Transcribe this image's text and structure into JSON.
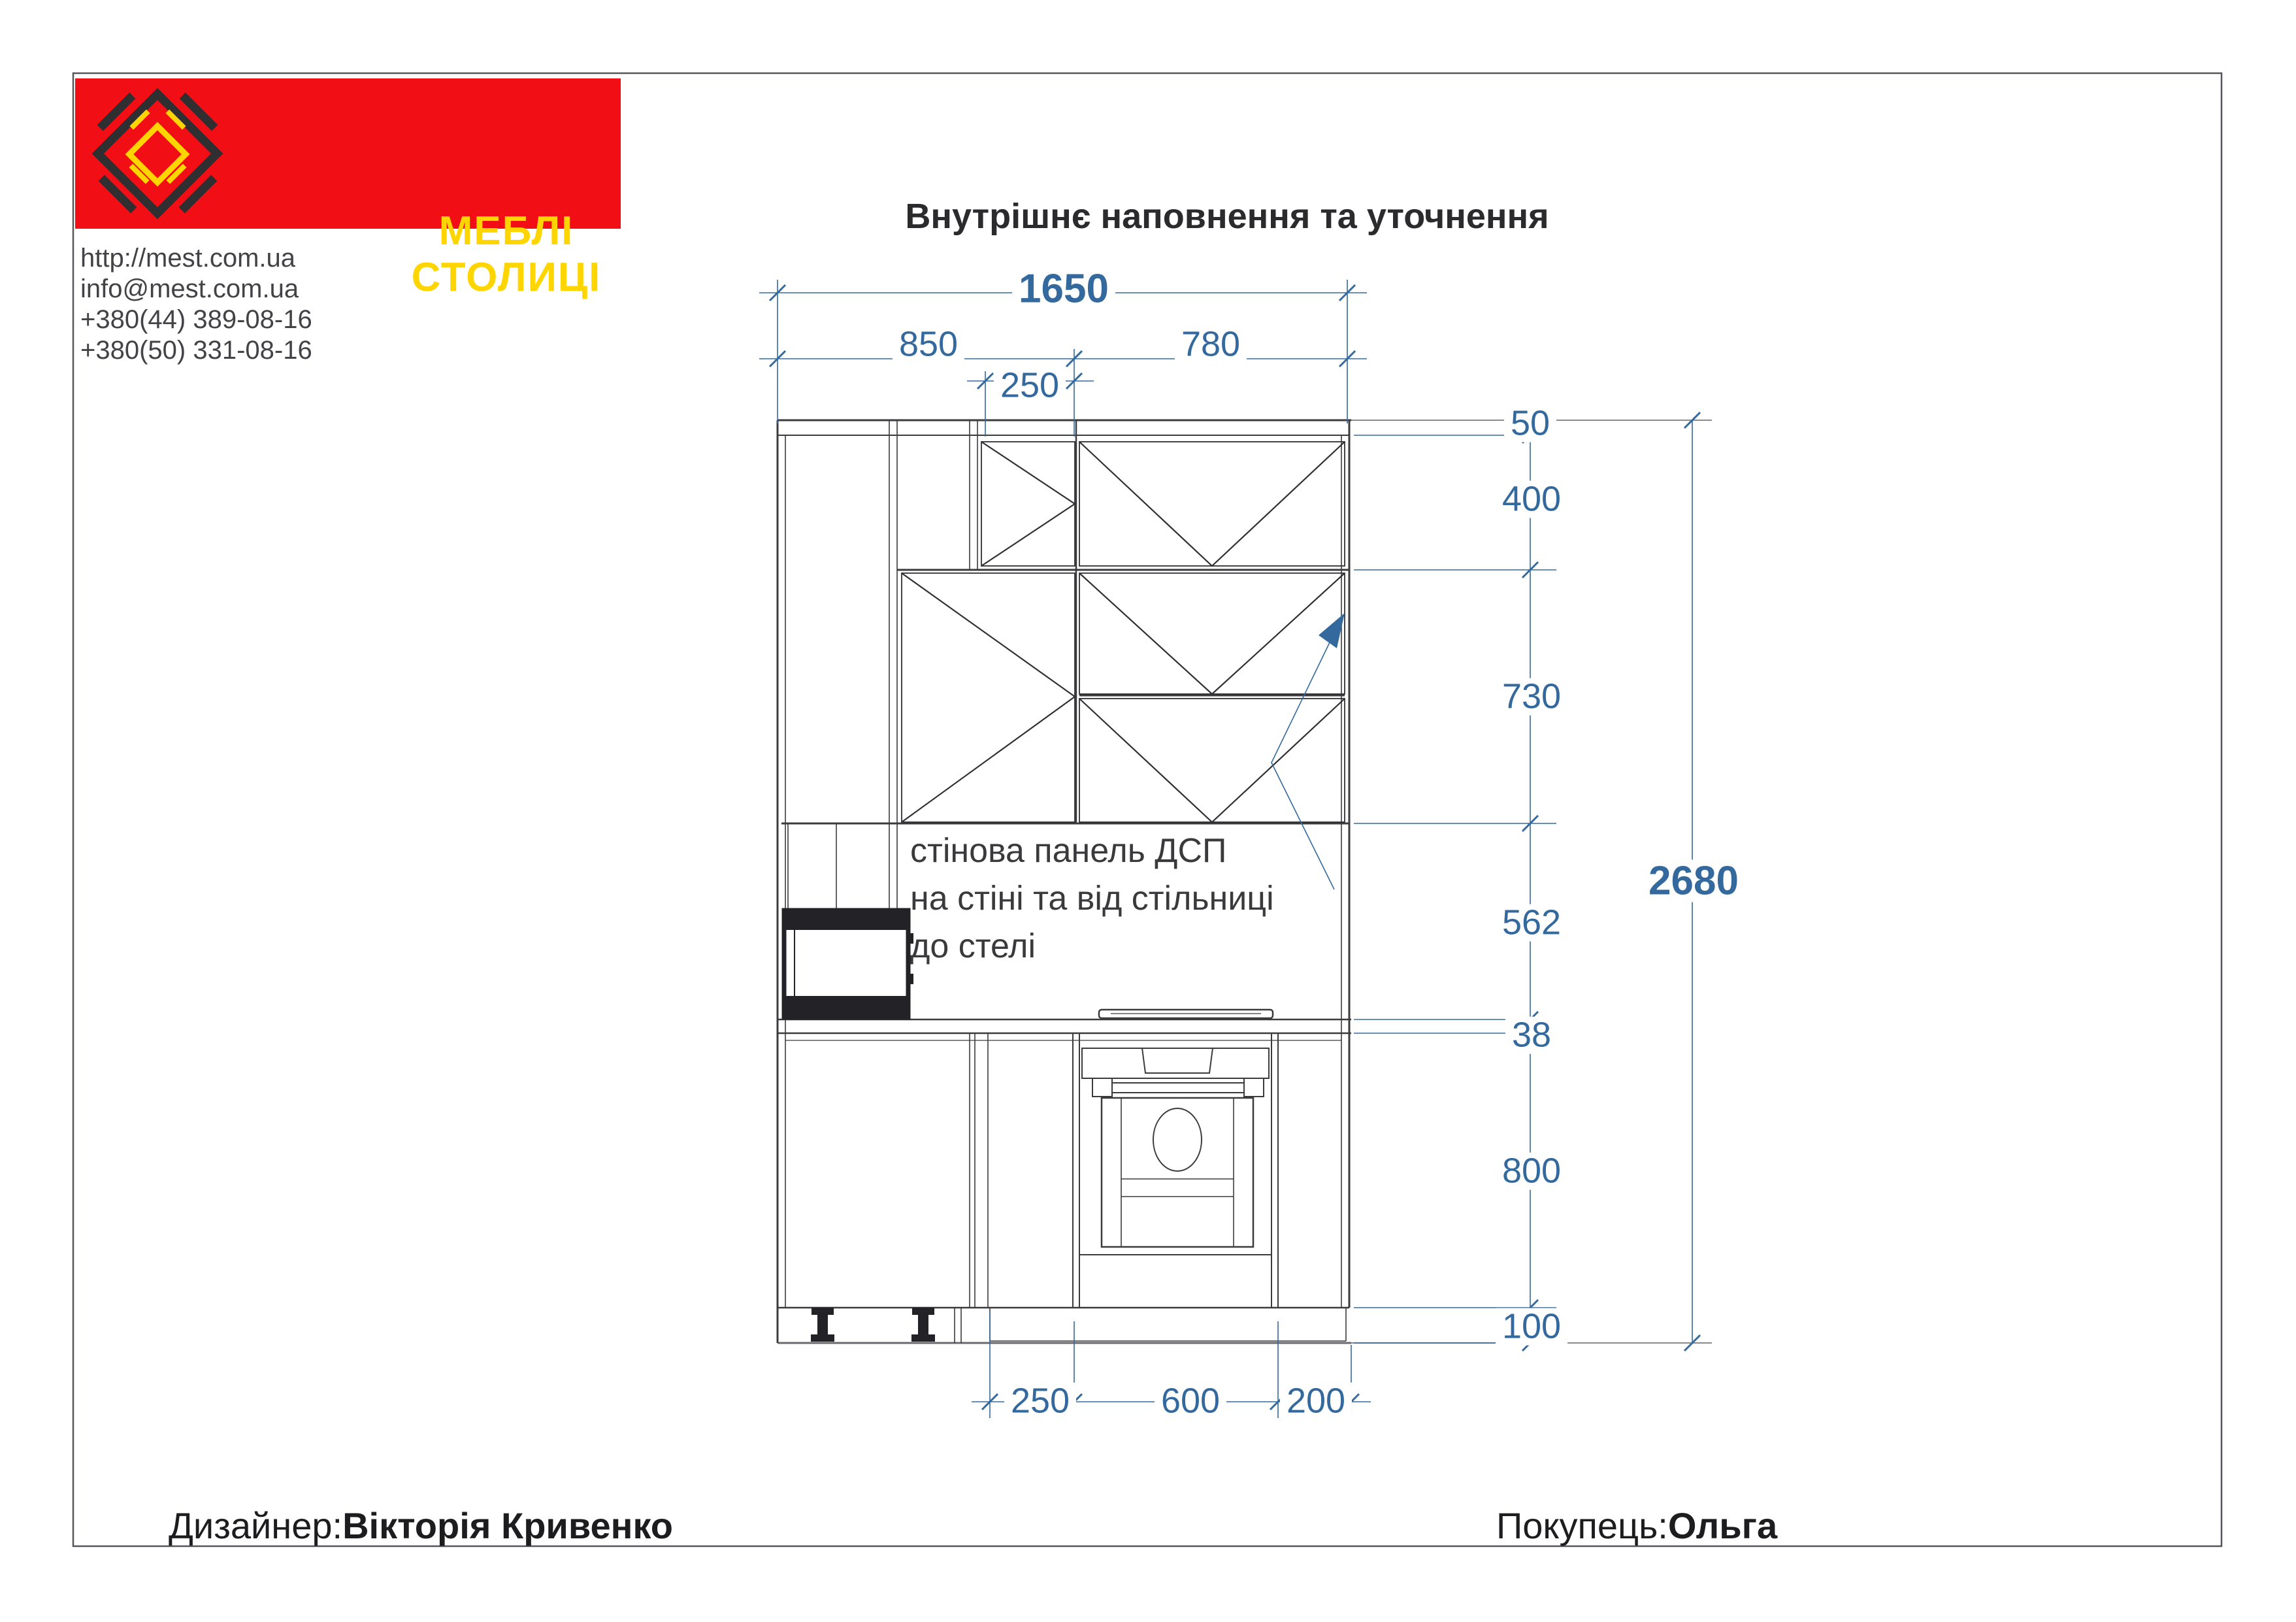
{
  "company": {
    "brand": "МЕБЛІ СТОЛИЦІ",
    "website": "http://mest.com.ua",
    "email": "info@mest.com.ua",
    "phone1": "+380(44)   389-08-16",
    "phone2": "+380(50)   331-08-16"
  },
  "title": "Внутрішнє наповнення та уточнення",
  "drawing": {
    "dims_top": {
      "total": "1650",
      "left": "850",
      "inner": "250",
      "right": "780"
    },
    "dims_right": {
      "top_filler": "50",
      "upper_row": "400",
      "lower_row": "730",
      "panel": "562",
      "countertop": "38",
      "base": "800",
      "plinth": "100",
      "overall": "2680"
    },
    "dims_bottom": {
      "cabinet": "250",
      "oven": "600",
      "end": "200"
    },
    "annotation": {
      "line1": "стінова панель ДСП",
      "line2": "на стіні та від стільниці",
      "line3": "до стелі"
    }
  },
  "footer": {
    "designer_label": "Дизайнер:",
    "designer_name": "Вікторія Кривенко",
    "customer_label": "Покупець:",
    "customer_name": "Ольга"
  },
  "colors": {
    "accent_red": "#f10e14",
    "accent_yellow": "#ffd500",
    "dimension_blue": "#34699e",
    "line_dark": "#3b3b3e"
  }
}
